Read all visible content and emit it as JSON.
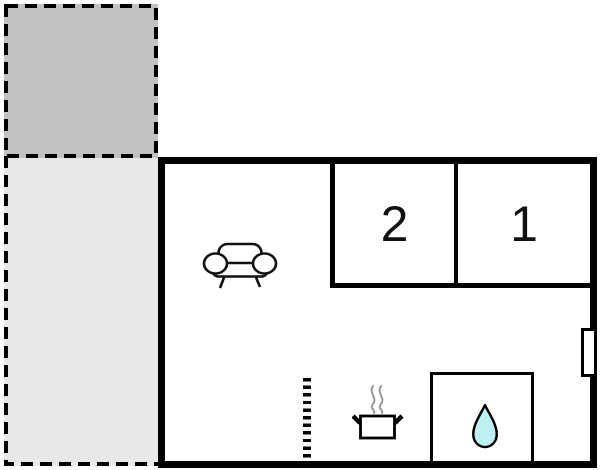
{
  "floorplan": {
    "rooms": [
      {
        "id": "room-2",
        "label": "2"
      },
      {
        "id": "room-1",
        "label": "1"
      }
    ],
    "icons": [
      "sofa-icon",
      "cooking-pot-icon",
      "steam-icon",
      "water-drop-icon",
      "window-marker",
      "terrace-upper",
      "terrace-lower"
    ],
    "colors": {
      "wall": "#000000",
      "floor": "#ffffff",
      "terrace_upper_fill": "#c1c1c1",
      "terrace_lower_fill": "#e8e8e8",
      "water_drop_fill": "#bdf0f3",
      "steam": "#999999"
    }
  }
}
